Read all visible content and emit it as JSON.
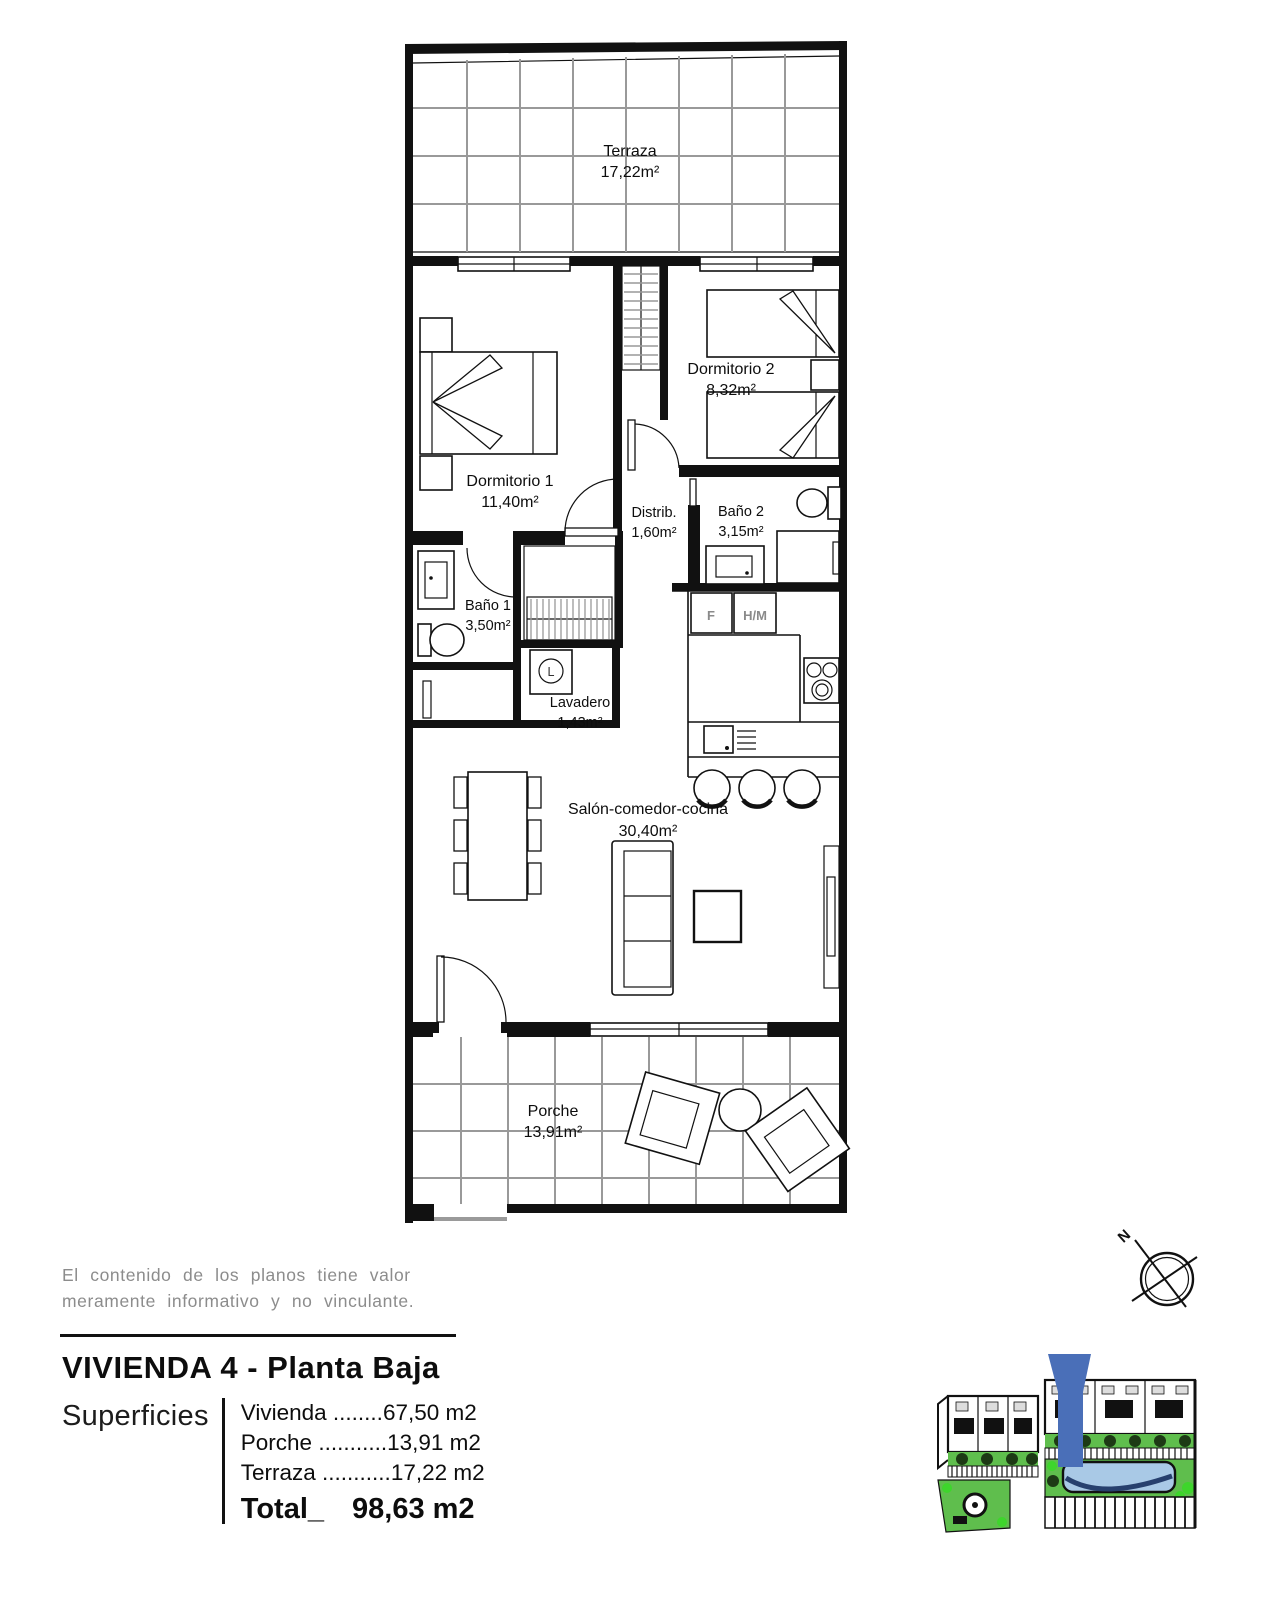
{
  "plan": {
    "rooms": {
      "terraza": {
        "name": "Terraza",
        "area": "17,22m²"
      },
      "dormitorio1": {
        "name": "Dormitorio 1",
        "area": "11,40m²"
      },
      "dormitorio2": {
        "name": "Dormitorio 2",
        "area": "8,32m²"
      },
      "distribuidor": {
        "name": "Distrib.",
        "area": "1,60m²"
      },
      "bano2": {
        "name": "Baño 2",
        "area": "3,15m²"
      },
      "bano1": {
        "name": "Baño 1",
        "area": "3,50m²"
      },
      "lavadero": {
        "name": "Lavadero",
        "area": "1,43m²"
      },
      "salon": {
        "name": "Salón-comedor-cocina",
        "area": "30,40m²"
      },
      "porche": {
        "name": "Porche",
        "area": "13,91m²"
      }
    },
    "appliance_labels": {
      "fridge": "F",
      "washer": "H/M",
      "laundry_machine": "L"
    },
    "compass_north_label": "N"
  },
  "disclaimer": {
    "line1": "El contenido de los planos tiene valor",
    "line2": "meramente informativo y no vinculante."
  },
  "footer": {
    "title": "VIVIENDA 4 - Planta Baja",
    "superficies_label": "Superficies",
    "rows": [
      {
        "label": "Vivienda",
        "leader": " ........",
        "value": "67,50 m2"
      },
      {
        "label": "Porche",
        "leader": " ...........",
        "value": "13,91 m2"
      },
      {
        "label": "Terraza",
        "leader": " ...........",
        "value": "17,22 m2"
      }
    ],
    "total_label": "Total_",
    "total_value": "98,63 m2"
  },
  "colors": {
    "plan_line": "#111111",
    "tile_grid": "#999999",
    "muted_text": "#8c8c8c",
    "marker_blue": "#4a6fb8",
    "landscape_green": "#5fbe4d",
    "bush_green": "#3ed52c",
    "pool_water": "#a9c9e6",
    "pool_wave": "#27406e",
    "tree_dark": "#1d3a15"
  }
}
